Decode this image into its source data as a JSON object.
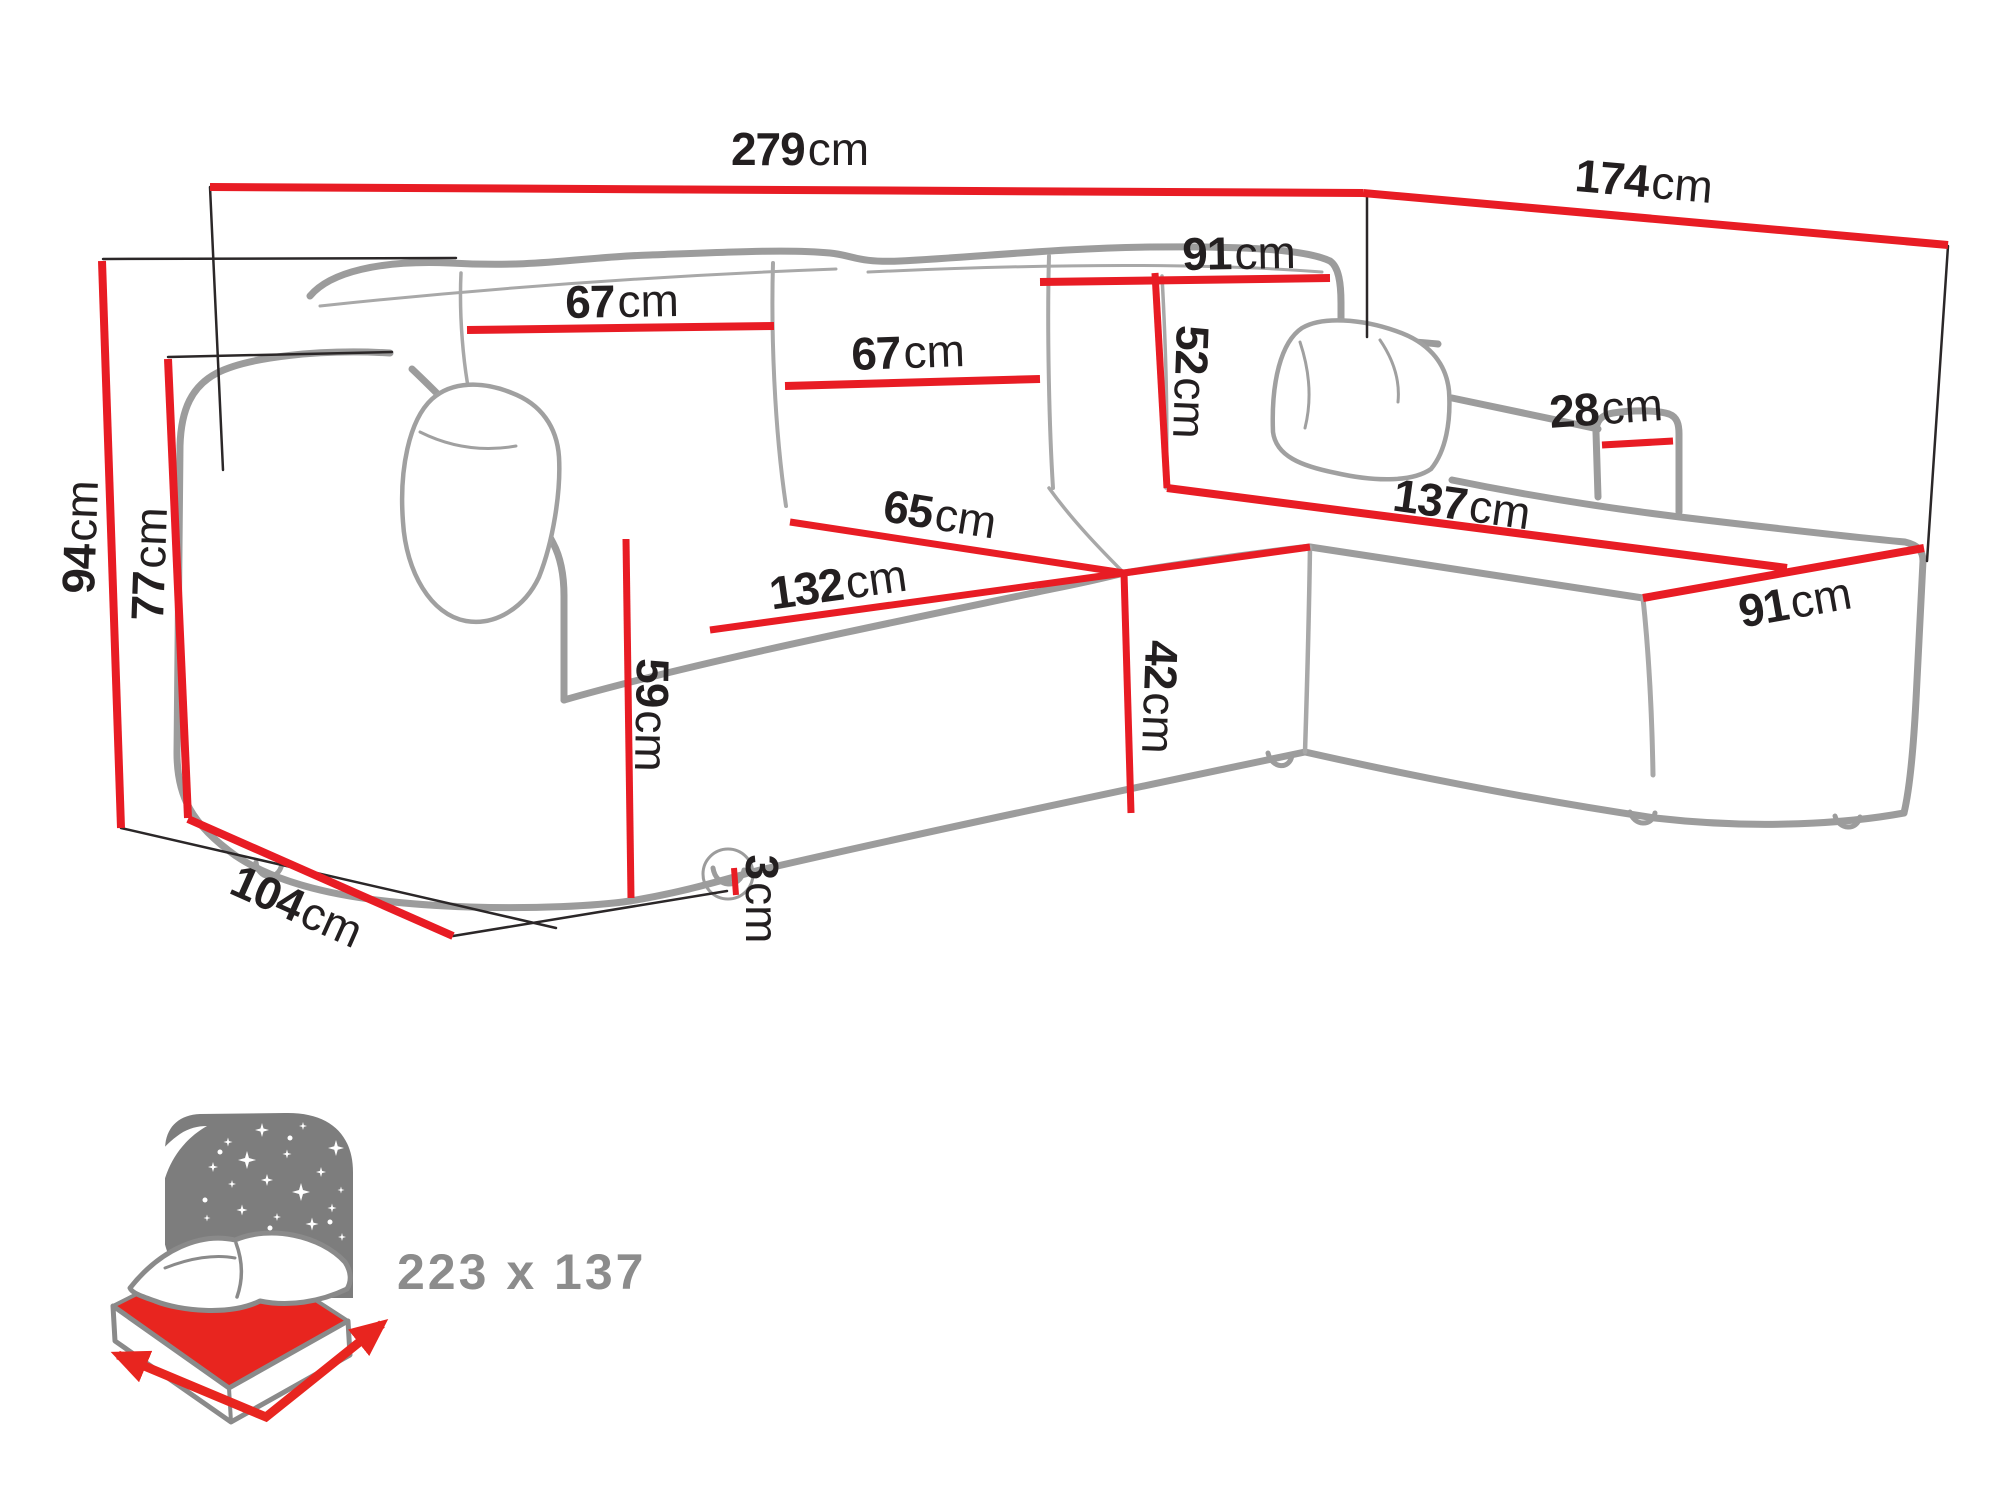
{
  "diagram": {
    "type": "furniture-dimension-diagram",
    "unit": "cm",
    "dimensions": {
      "d279": {
        "num": "279",
        "unit": "cm"
      },
      "d174": {
        "num": "174",
        "unit": "cm"
      },
      "d91_top": {
        "num": "91",
        "unit": "cm"
      },
      "d52": {
        "num": "52",
        "unit": "cm"
      },
      "d67_left": {
        "num": "67",
        "unit": "cm"
      },
      "d67_mid": {
        "num": "67",
        "unit": "cm"
      },
      "d65": {
        "num": "65",
        "unit": "cm"
      },
      "d132": {
        "num": "132",
        "unit": "cm"
      },
      "d137": {
        "num": "137",
        "unit": "cm"
      },
      "d91_right": {
        "num": "91",
        "unit": "cm"
      },
      "d28": {
        "num": "28",
        "unit": "cm"
      },
      "d42": {
        "num": "42",
        "unit": "cm"
      },
      "d59": {
        "num": "59",
        "unit": "cm"
      },
      "d3": {
        "num": "3",
        "unit": "cm"
      },
      "d104": {
        "num": "104",
        "unit": "cm"
      },
      "d94": {
        "num": "94",
        "unit": "cm"
      },
      "d77": {
        "num": "77",
        "unit": "cm"
      }
    },
    "bed": {
      "size": "223 x 137"
    },
    "colors": {
      "dimension_red": "#e81c24",
      "outline_grey": "#9c9c9c",
      "extension_black": "#2b2728",
      "label_black": "#231f20",
      "icon_grey": "#7d7d7d",
      "icon_text_grey": "#8c8c8c",
      "mattress_red": "#e8251f"
    }
  }
}
